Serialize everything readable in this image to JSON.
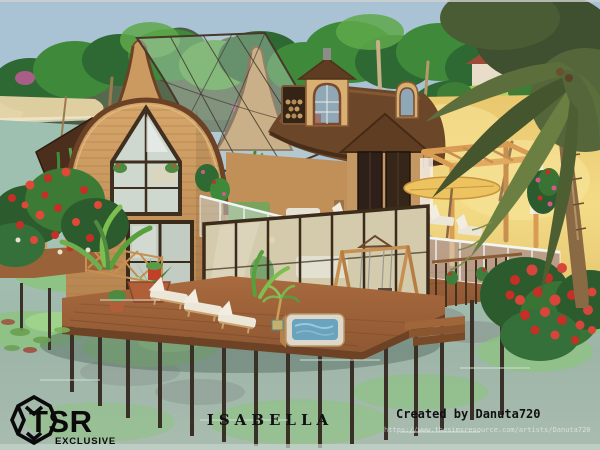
{
  "overlay": {
    "logo": {
      "brand": "TSR",
      "tagline": "EXCLUSIVE"
    },
    "title": "ISABELLA",
    "credit": "Created by Danuta720",
    "url": "https://www.thesimsresource.com/artists/Danuta720"
  },
  "palette": {
    "sky": "#a9c2d4",
    "mountain": "#4c5c47",
    "canopyDark": "#2e6832",
    "canopyMid": "#3f8a3a",
    "canopyLight": "#5ea84a",
    "sand": "#e9c76d",
    "sandLight": "#f3db86",
    "waterTop": "#a6c4b5",
    "waterBottom": "#9db5a8",
    "algae": "#8bc47e",
    "woodLight": "#d6a76b",
    "woodDark": "#b5824e",
    "thatch": "#6b4628",
    "trim": "#6b4226",
    "deck": "#9a6239",
    "deckDark": "#6e4224",
    "pergola": "#d89c54",
    "glassRoof": "rgba(198,214,204,0.38)",
    "railGlass": "rgba(215,228,230,0.45)",
    "flowerRed": "#c52f26",
    "leafDark": "#2c5c2e",
    "stilt": "#3a3028",
    "loungerWhite": "#ece6d8",
    "textBlack": "#111111",
    "urlColor": "rgba(255,255,255,0.55)"
  }
}
